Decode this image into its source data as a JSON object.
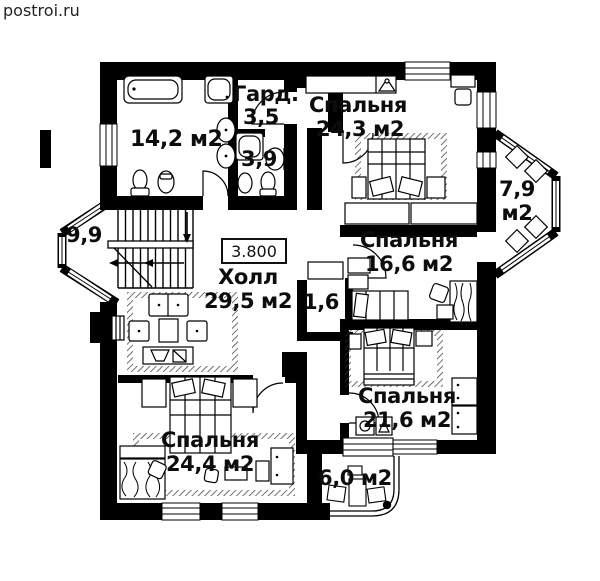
{
  "watermark": "postroi.ru",
  "plan": {
    "type": "floor-plan",
    "elevation_mark": "3.800",
    "rooms": {
      "bathroom": {
        "area_label": "14,2 м2"
      },
      "wardrobe": {
        "name": "Гард.",
        "area": "3,5"
      },
      "wc": {
        "area": "3,9"
      },
      "bedroom_top": {
        "name": "Спальня",
        "area": "24,3 м2"
      },
      "balcony_right": {
        "area": "7,9",
        "unit": "м2"
      },
      "stair_hall": {
        "area": "9,9"
      },
      "hall": {
        "name": "Холл",
        "area": "29,5 м2"
      },
      "closet": {
        "area": "1,6"
      },
      "bedroom_mid": {
        "name": "Спальня",
        "area": "16,6 м2"
      },
      "bedroom_bottom_right": {
        "name": "Спальня",
        "area": "21,6 м2"
      },
      "bedroom_bottom_left": {
        "name": "Спальня",
        "area": "24,4 м2"
      },
      "balcony_bottom": {
        "area": "6,0 м2"
      }
    },
    "colors": {
      "wall": "#000000",
      "background": "#ffffff",
      "text": "#111111"
    }
  }
}
